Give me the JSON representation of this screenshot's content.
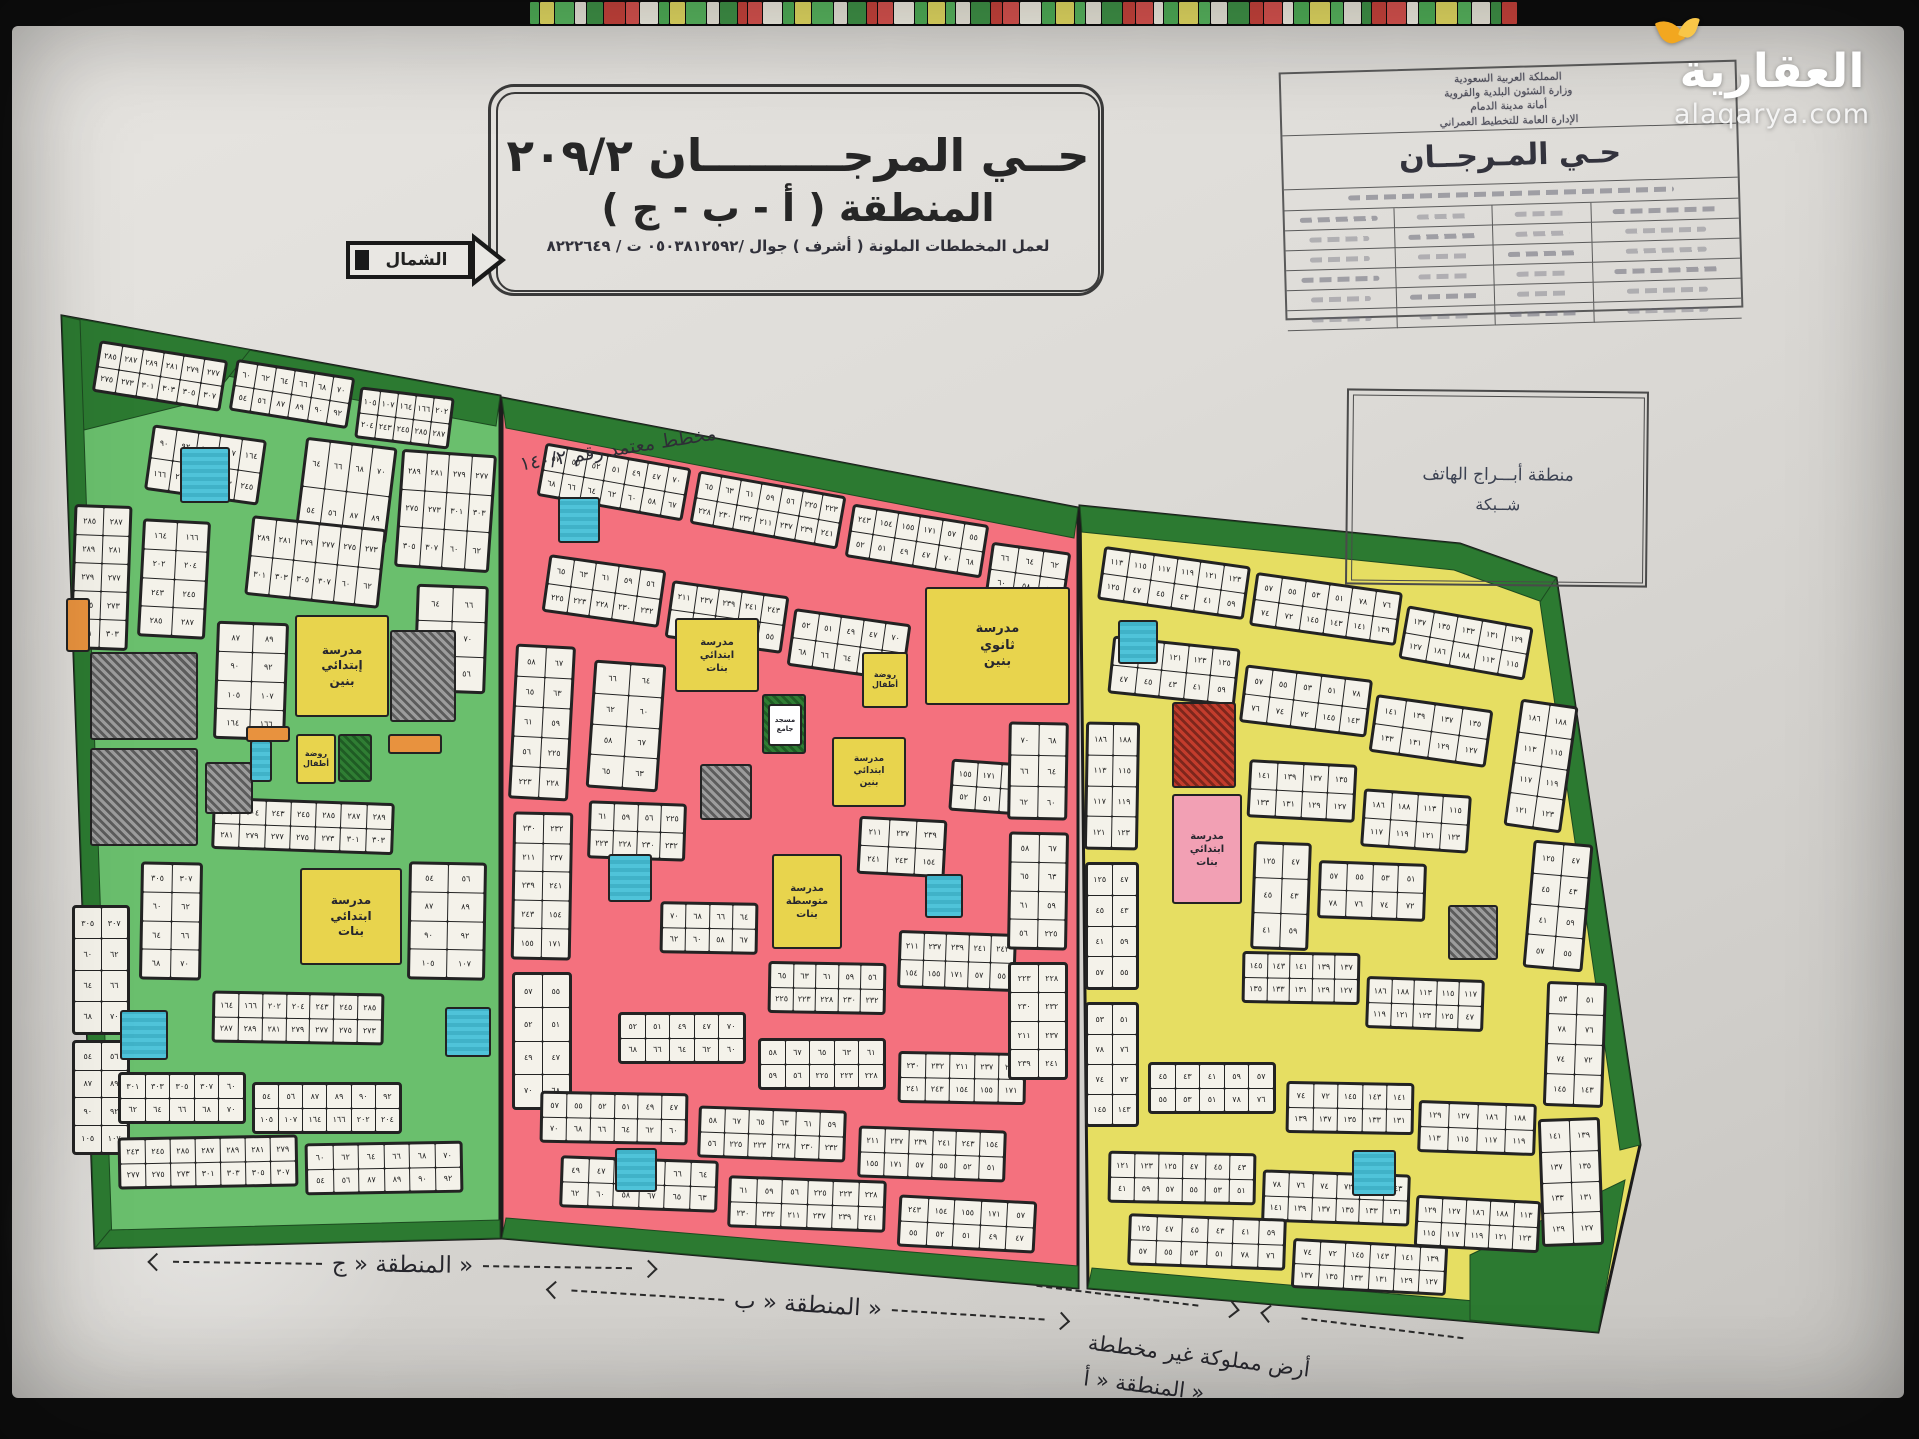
{
  "brand": {
    "name": "العقارية",
    "domain": "alaqarya.com"
  },
  "title_box": {
    "line1": "حــي المرجـــــــــان ٢٠٩/٢",
    "line2": "المنطقة ( أ - ب - ج )",
    "line3": "لعمل المخططات الملونة ( أشرف ) جوال /٠٥٠٣٨١٢٥٩٢ ت / ٨٢٢٢٦٤٩"
  },
  "north": {
    "label": "الشمال"
  },
  "approval": {
    "lines": [
      "المملكة العربية السعودية",
      "وزارة الشئون البلدية والقروية",
      "أمانة مدينة الدمام",
      "الإدارة العامة للتخطيط العمراني"
    ],
    "district": "حـي المـرجــان"
  },
  "phone_box": {
    "line1": "منطقة أبـــراج الهاتف",
    "line2": "شــبكة"
  },
  "note": {
    "approved": "مخطط معتمد رقم ١٤٠/٢"
  },
  "labels": {
    "c": "المنطقة « ج »",
    "b": "المنطقة « ب »",
    "a_line1": "أرض مملوكة غير مخططة",
    "a_line2": "المنطقة « أ »"
  },
  "zones": [
    {
      "id": "c",
      "name": "المنطقة ج",
      "color": "#6abf6d"
    },
    {
      "id": "b",
      "name": "المنطقة ب",
      "color": "#f4717e"
    },
    {
      "id": "a",
      "name": "المنطقة أ",
      "color": "#e6de62"
    }
  ],
  "facilities": [
    {
      "id": "sch-c-banin",
      "zone": "c",
      "label": "مدرسة\nإبتدائي\nبنين",
      "color": "#e8d44d",
      "fs": 12
    },
    {
      "id": "rawda-c",
      "zone": "c",
      "label": "روضة\nأطفال",
      "color": "#e8d44d",
      "fs": 8
    },
    {
      "id": "sch-c-banat",
      "zone": "c",
      "label": "مدرسة\nابتدائي\nبنات",
      "color": "#e8d44d",
      "fs": 12
    },
    {
      "id": "sch-b-thanawi",
      "zone": "b",
      "label": "مدرسة\nثانوي\nبنين",
      "color": "#e8d44d",
      "fs": 13
    },
    {
      "id": "sch-b-banat",
      "zone": "b",
      "label": "مدرسة\nابتدائي\nبنات",
      "color": "#e8d44d",
      "fs": 10
    },
    {
      "id": "rawda-b",
      "zone": "b",
      "label": "روضة\nأطفال",
      "color": "#e8d44d",
      "fs": 8
    },
    {
      "id": "masjid-b",
      "zone": "b",
      "label": "مسجد\nجامع",
      "color": "#ffffff",
      "fs": 7
    },
    {
      "id": "sch-b-banin",
      "zone": "b",
      "label": "مدرسة\nابتدائي\nبنين",
      "color": "#e8d44d",
      "fs": 9
    },
    {
      "id": "sch-b-mutawassita",
      "zone": "b",
      "label": "مدرسة\nمتوسطة\nبنات",
      "color": "#e8d44d",
      "fs": 10
    },
    {
      "id": "sch-a-banat",
      "zone": "a",
      "label": "مدرسة\nابتدائي\nبنات",
      "color": "#f2a0b4",
      "fs": 10
    }
  ],
  "plot_numbers": {
    "c": [
      "٢٨٥",
      "٢٨٧",
      "٢٨٩",
      "٢٨١",
      "٢٧٩",
      "٢٧٧",
      "٢٧٥",
      "٢٧٣",
      "٣٠١",
      "٣٠٣",
      "٣٠٥",
      "٣٠٧",
      "٦٠",
      "٦٢",
      "٦٤",
      "٦٦",
      "٦٨",
      "٧٠",
      "٥٤",
      "٥٦",
      "٨٧",
      "٨٩",
      "٩٠",
      "٩٢",
      "١٠٥",
      "١٠٧",
      "١٦٤",
      "١٦٦",
      "٢٠٢",
      "٢٠٤",
      "٢٤٣",
      "٢٤٥"
    ],
    "b": [
      "٥٧",
      "٥٥",
      "٥٢",
      "٥١",
      "٤٩",
      "٤٧",
      "٧٠",
      "٦٨",
      "٦٦",
      "٦٤",
      "٦٢",
      "٦٠",
      "٥٨",
      "٦٧",
      "٦٥",
      "٦٣",
      "٦١",
      "٥٩",
      "٥٦",
      "٢٢٥",
      "٢٢٣",
      "٢٢٨",
      "٢٣٠",
      "٢٣٢",
      "٢١١",
      "٢٣٧",
      "٢٣٩",
      "٢٤١",
      "٢٤٣",
      "١٥٤",
      "١٥٥",
      "١٧١"
    ],
    "a": [
      "١١٣",
      "١١٥",
      "١١٧",
      "١١٩",
      "١٢١",
      "١٢٣",
      "١٢٥",
      "٤٧",
      "٤٥",
      "٤٣",
      "٤١",
      "٥٩",
      "٥٧",
      "٥٥",
      "٥٣",
      "٥١",
      "٧٨",
      "٧٦",
      "٧٤",
      "٧٢",
      "١٤٥",
      "١٤٣",
      "١٤١",
      "١٣٩",
      "١٣٧",
      "١٣٥",
      "١٣٣",
      "١٣١",
      "١٢٩",
      "١٢٧",
      "١٨٦",
      "١٨٨"
    ]
  },
  "strip_palette": [
    "#4fae57",
    "#e9e6da",
    "#d9534f",
    "#e3da62",
    "#3f9247",
    "#f0ede2",
    "#58b65f",
    "#c8433c"
  ]
}
